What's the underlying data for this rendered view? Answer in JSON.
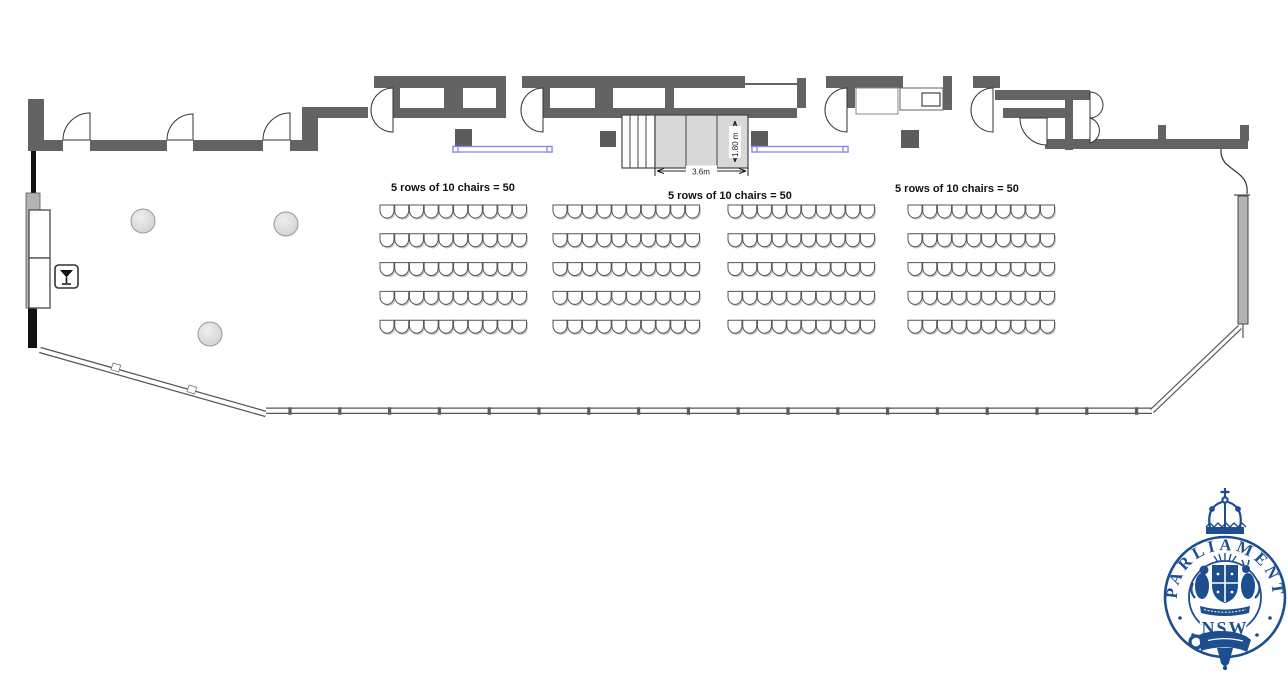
{
  "diagram": {
    "type": "function-room-floor-plan",
    "seating": {
      "labels": [
        "5 rows of 10 chairs = 50",
        "5 rows of 10 chairs = 50",
        "5 rows of 10 chairs = 50"
      ],
      "blocks": [
        {
          "x": 380,
          "y": 205,
          "rows": 5,
          "cols": 10
        },
        {
          "x": 553,
          "y": 205,
          "rows": 5,
          "cols": 10
        },
        {
          "x": 728,
          "y": 205,
          "rows": 5,
          "cols": 10
        },
        {
          "x": 908,
          "y": 205,
          "rows": 5,
          "cols": 10
        }
      ],
      "chair": {
        "pitch_x": 14.72,
        "row_gap": 28.8,
        "width": 14,
        "height": 13
      },
      "chairs_per_block": 50
    },
    "stage": {
      "width_label": "3.6m",
      "depth_label": "1.80 m"
    },
    "icons": {
      "bar": "martini-icon"
    },
    "colors": {
      "wall": "#636363",
      "wall_light": "#b3b3b3",
      "stage_fill": "#d8d8d8",
      "speaker": "#5c5c5c",
      "table_blue": "#8585ea",
      "chair_stroke": "#555555",
      "chair_shadow": "#c9c9c9",
      "logo_blue": "#1d4e90"
    }
  },
  "logo": {
    "top_text": "PARLIAMENT",
    "bottom_text": "NSW"
  }
}
